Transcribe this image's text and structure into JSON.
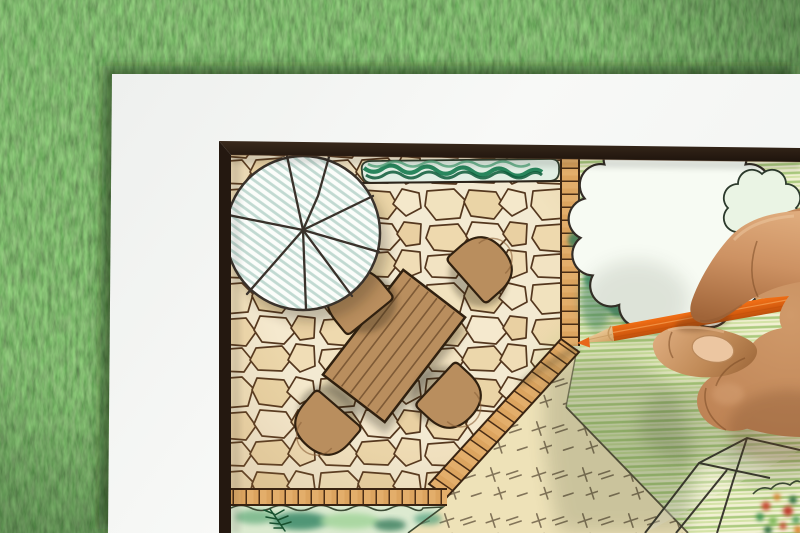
{
  "scene": {
    "type": "photograph",
    "subject": "hand drawing a backyard garden landscape design plan with an orange colored pencil",
    "surface": "white paper sheet lying on green grass"
  },
  "palette": {
    "grass": "#4e7d3d",
    "paper": "#f5f6f4",
    "frame": "#241810",
    "stone-bg": "#f3ead2",
    "stone-line": "#54371e",
    "brick": "#dca45f",
    "brick-line": "#4a2d15",
    "hedge": "#157a4e",
    "umbrella-hatch": "#b7d3ca",
    "wood": "#b98e5e",
    "wood-line": "#30200f",
    "lawn-hatch": "#a9c97a",
    "lawn-cream": "#eee2b8",
    "tick": "#6f6048",
    "tree-line": "#332d26",
    "canopy-wash": "#9ccab4",
    "bush": "#2f8f5a",
    "bed": "#dcead0",
    "pencil": "#ef6d15",
    "pencil-wood": "#ecc68f",
    "skin": "#bd8254",
    "nail": "#ecc6a1",
    "ink": "#2f2c26"
  },
  "plan_elements": [
    "flagstone-patio",
    "patio-umbrella",
    "dining-table",
    "patio-chair",
    "hedge-strip",
    "brick-edging",
    "shade-tree",
    "evergreen-bush",
    "hatched-lawn",
    "dashed-lawn",
    "planting-bed",
    "stepping-stones",
    "flower-bed"
  ],
  "foreground": [
    "right-hand",
    "orange-colored-pencil"
  ]
}
